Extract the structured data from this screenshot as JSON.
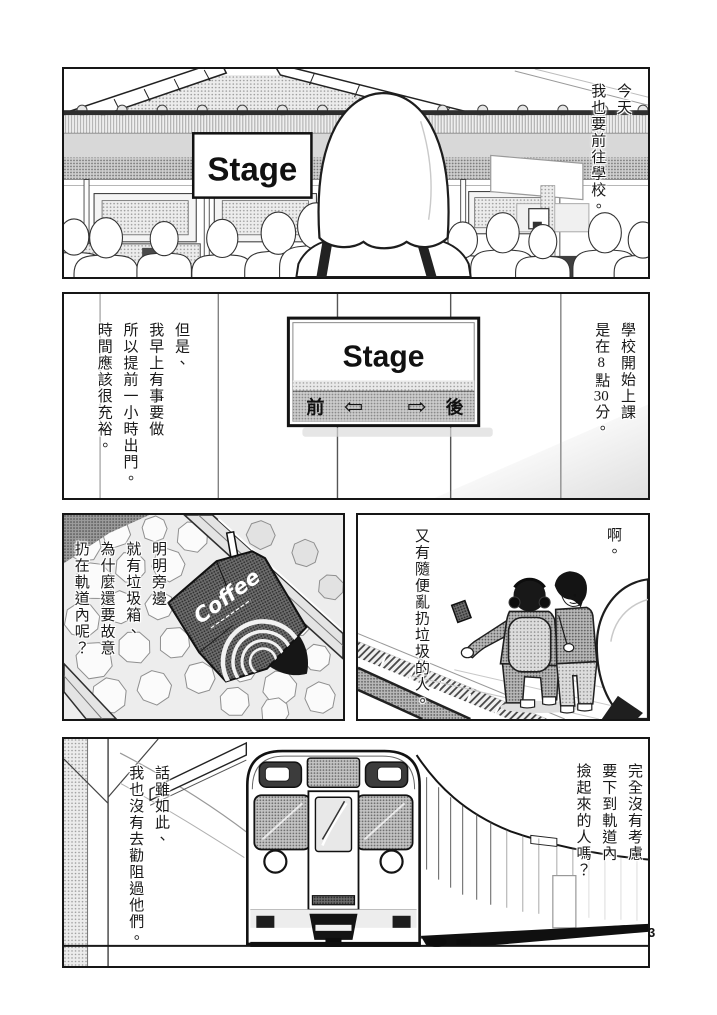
{
  "page": {
    "number": "3"
  },
  "colors": {
    "ink": "#1a1a1a",
    "paper": "#ffffff",
    "tone_light": "#e0e0e0",
    "tone_mid": "#bdbdbd",
    "tone_dark": "#6e6e6e"
  },
  "panel1": {
    "narration_cols": [
      "今天",
      "我也要前往學校。"
    ],
    "sign_label": "Stage"
  },
  "panel2": {
    "narration_right_cols": [
      "學校開始上課",
      "是在8點30分。"
    ],
    "narration_left_cols": [
      "但是、",
      "我早上有事要做",
      "所以提前一小時出門。",
      "時間應該很充裕。"
    ],
    "sign": {
      "label": "Stage",
      "front": "前",
      "back": "後",
      "left_arrow": "⇦",
      "right_arrow": "⇨"
    }
  },
  "panel3_left": {
    "narration_cols": [
      "明明旁邊",
      "就有垃圾箱、",
      "為什麼還要故意",
      "扔在軌道內呢？"
    ],
    "carton_label": "Coffee"
  },
  "panel3_right": {
    "sfx": "啊。",
    "narration_cols": [
      "又有隨便亂扔垃圾的人。"
    ]
  },
  "panel4": {
    "narration_right_cols": [
      "完全沒有考慮",
      "要下到軌道內",
      "撿起來的人嗎？"
    ],
    "narration_left_cols": [
      "話雖如此、",
      "我也沒有去勸阻過他們。"
    ]
  }
}
